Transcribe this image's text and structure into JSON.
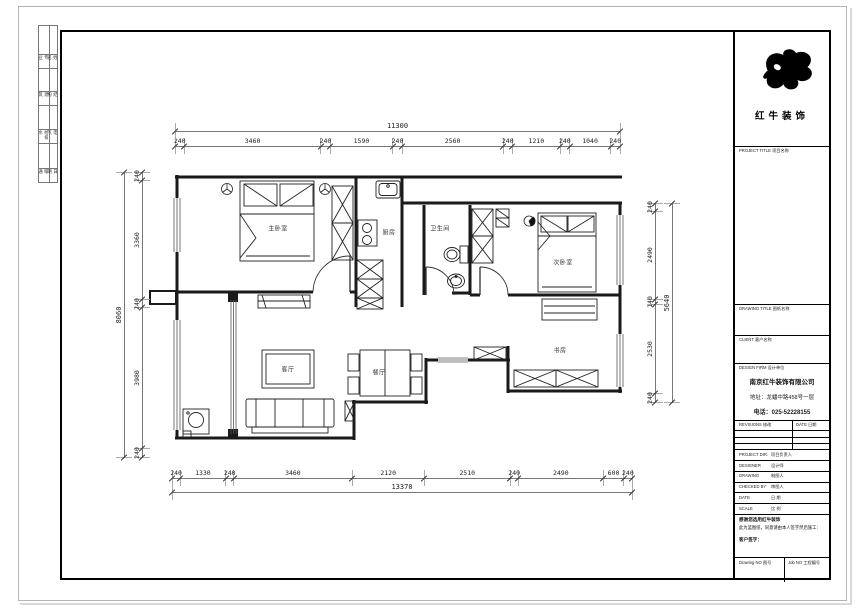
{
  "sheet": {
    "binding_strip": {
      "rows": [
        [
          "专 业",
          "姓 名"
        ],
        [
          "建 筑",
          "结 构"
        ],
        [
          "给排水",
          "电 气"
        ],
        [
          "暖 通",
          "日 期"
        ]
      ]
    }
  },
  "plan": {
    "rooms": {
      "master_bedroom": "主卧室",
      "kitchen": "厨房",
      "bathroom": "卫生间",
      "second_bedroom": "次卧室",
      "living_room": "客厅",
      "dining_room": "餐厅",
      "study": "书房"
    },
    "dimensions": {
      "top": {
        "segments": [
          "240",
          "3460",
          "240",
          "1590",
          "240",
          "2560",
          "240",
          "1210",
          "240",
          "1040",
          "240"
        ],
        "total": "11300"
      },
      "bottom": {
        "segments": [
          "240",
          "1330",
          "240",
          "3460",
          "2120",
          "2510",
          "240",
          "2490",
          "600",
          "240"
        ],
        "total": "13370"
      },
      "left": {
        "segments": [
          "240",
          "3360",
          "240",
          "3980",
          "240"
        ],
        "total": "8060"
      },
      "right": {
        "segments": [
          "240",
          "2490",
          "140",
          "2530",
          "240"
        ],
        "total": "5640"
      }
    }
  },
  "title_block": {
    "brand": "红牛装饰",
    "project_title_label": "PROJECT TITLE 项目名称",
    "drawing_title_label": "DRAWING TITLE 图纸名称",
    "client_label": "CLIENT 客户名称",
    "design_firm_label": "DESIGN FIRM 设计单位",
    "company": "南京红牛装饰有限公司",
    "address": "地址：龙蟠中路458号一层",
    "phone": "电话：025-52228155",
    "revisions_label": "REVISIONS 修改",
    "date_col_label": "DATE 日期",
    "staff_rows": [
      {
        "en": "PROJECT DIR.",
        "cn": "项目负责人"
      },
      {
        "en": "DESIGNER",
        "cn": "设计师"
      },
      {
        "en": "DRAWING",
        "cn": "制图人"
      },
      {
        "en": "CHECKED BY",
        "cn": "审图人"
      },
      {
        "en": "DATE",
        "cn": "日 期"
      },
      {
        "en": "SCALE",
        "cn": "比 例"
      }
    ],
    "note_line1": "感谢您选用红牛装饰",
    "note_line2": "此为蓝图纸，同意请由本人签字然后施工：",
    "note_line3": "客户签字：",
    "drawing_no_label": "Drawing NO 图号",
    "job_no_label": "Job NO 工程编号"
  }
}
